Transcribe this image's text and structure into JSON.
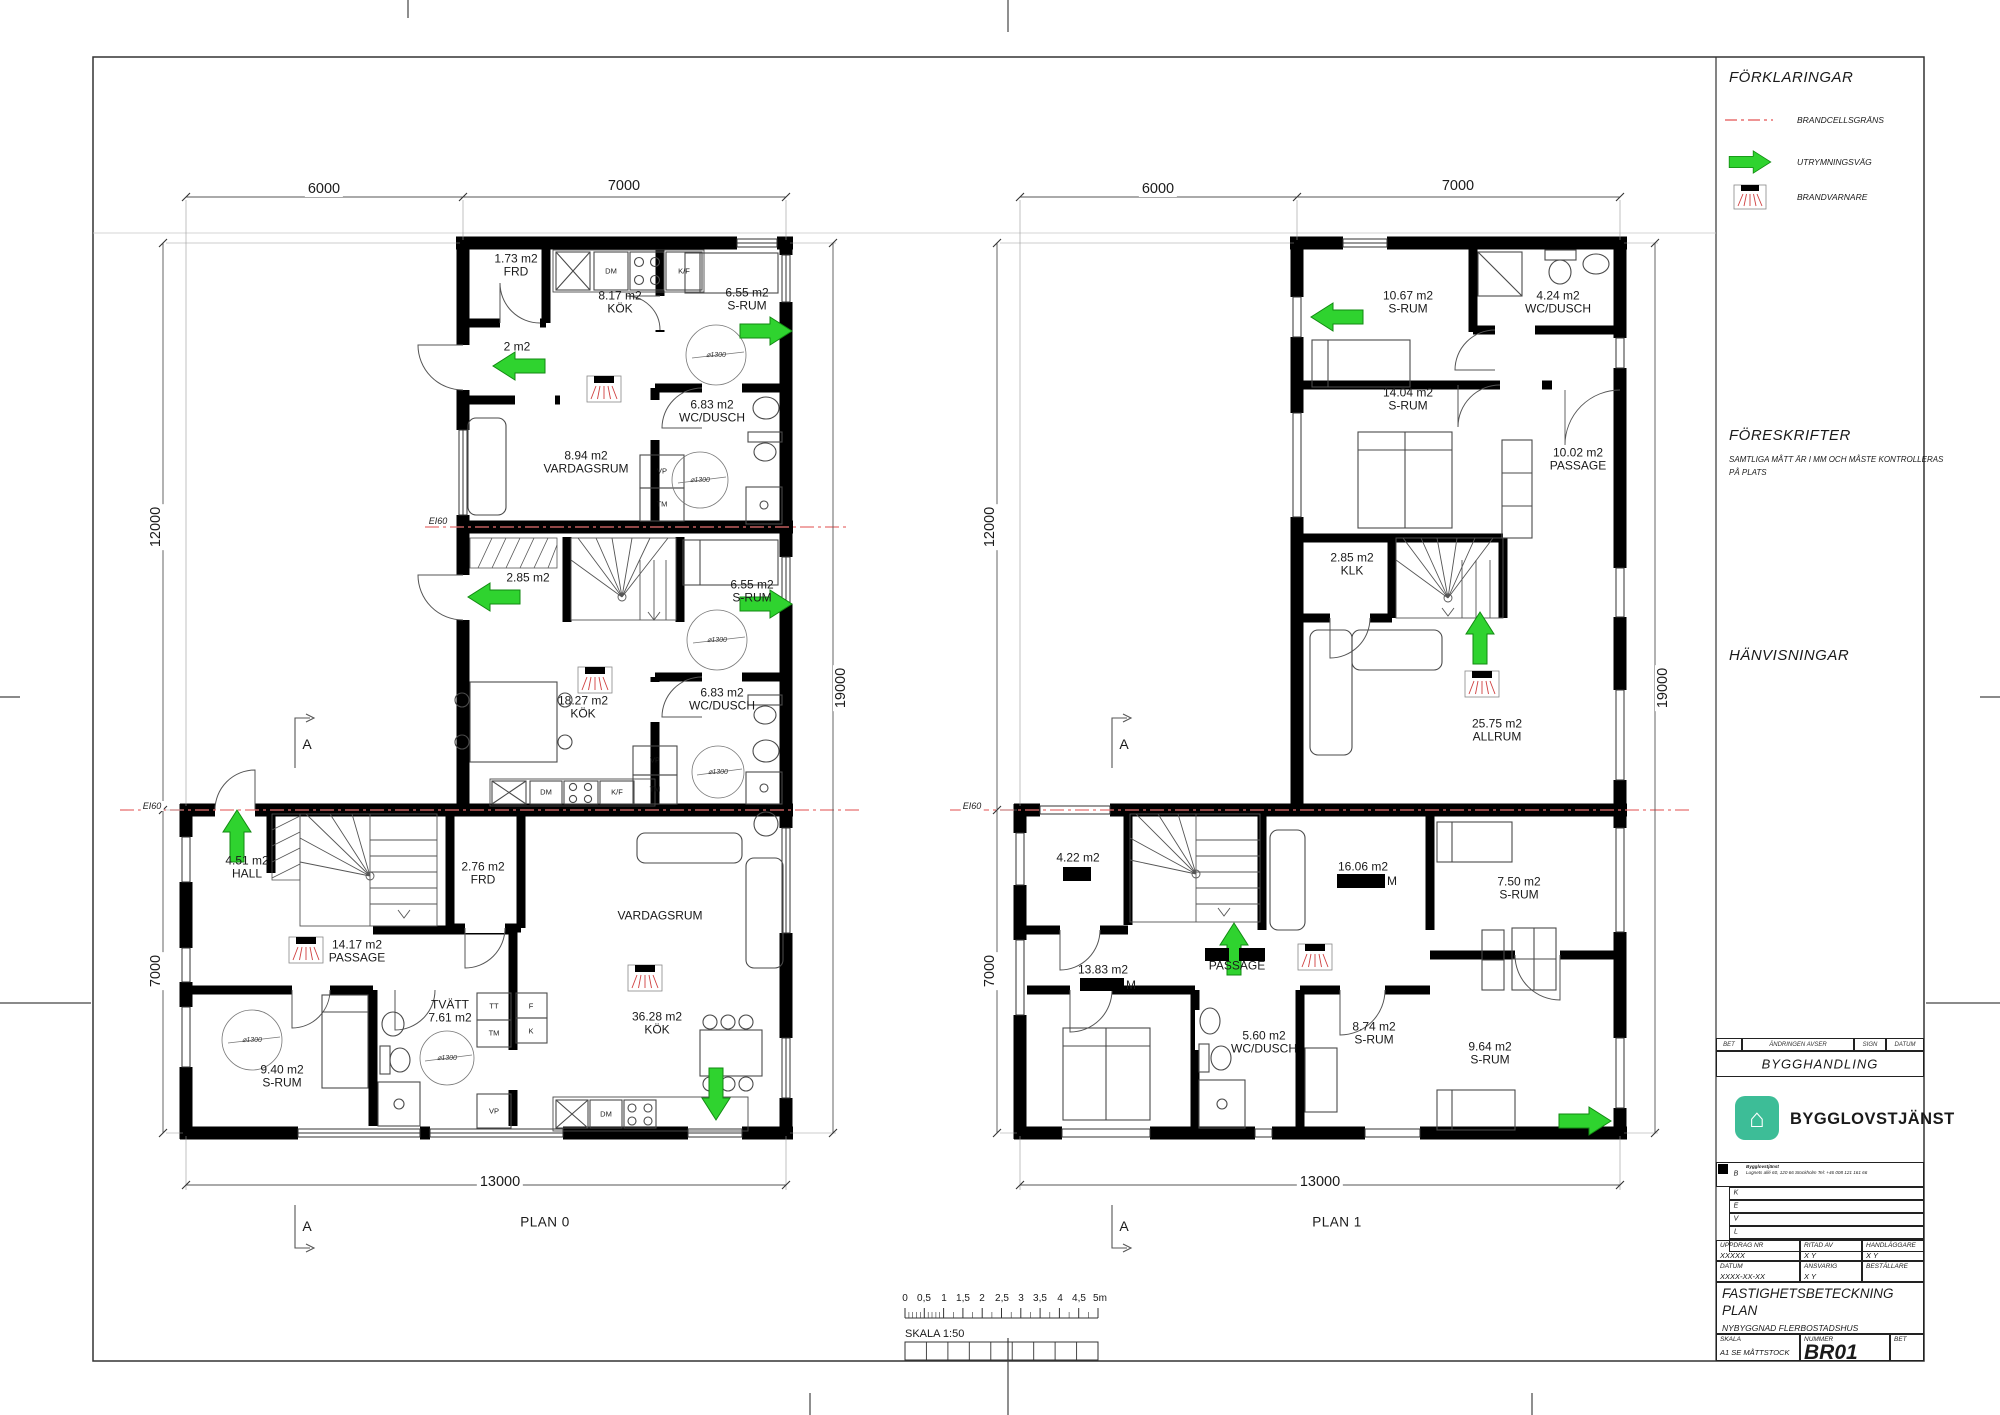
{
  "sheet": {
    "plan0_title": "PLAN 0",
    "plan1_title": "PLAN 1"
  },
  "colors": {
    "evacuation_green": "#2fd32f",
    "firecell_red": "#e87070",
    "logo_teal": "#3dbd97"
  },
  "dims": {
    "w6000": "6000",
    "w7000": "7000",
    "h12000": "12000",
    "h7000": "7000",
    "h19000": "19000",
    "w13000": "13000"
  },
  "misc": {
    "diameter": "⌀1300",
    "ei60": "EI60",
    "section_letter": "A"
  },
  "fixtures": {
    "dm": "DM",
    "kf": "K/F",
    "vp": "VP",
    "tm": "TM",
    "tt": "TT",
    "f": "F",
    "k": "K"
  },
  "plan0": {
    "rooms": {
      "frd_top": {
        "area": "1.73 m2",
        "name": "FRD"
      },
      "kok_top": {
        "area": "8.17 m2",
        "name": "KÖK"
      },
      "srum_top": {
        "area": "6.55 m2",
        "name": "S-RUM"
      },
      "hall_top": {
        "area": "2 m2"
      },
      "wc_top": {
        "area": "6.83 m2",
        "name": "WC/DUSCH"
      },
      "vardagsrum_top": {
        "area": "8.94 m2",
        "name": "VARDAGSRUM"
      },
      "hall_mid": {
        "area": "2.85 m2"
      },
      "srum_mid": {
        "area": "6.55 m2",
        "name": "S-RUM"
      },
      "kok_mid": {
        "area": "18.27 m2",
        "name": "KÖK"
      },
      "wc_mid": {
        "area": "6.83 m2",
        "name": "WC/DUSCH"
      },
      "hall_bot": {
        "area": "4.51 m2",
        "name": "HALL"
      },
      "frd_bot": {
        "area": "2.76 m2",
        "name": "FRD"
      },
      "passage_bot": {
        "area": "14.17 m2",
        "name": "PASSAGE"
      },
      "srum_bot": {
        "area": "9.40 m2",
        "name": "S-RUM"
      },
      "tvatt": {
        "name": "TVÄTT",
        "area": "7.61 m2"
      },
      "vardagsrum_bot": {
        "name": "VARDAGSRUM"
      },
      "kok_bot": {
        "area": "36.28 m2",
        "name": "KÖK"
      }
    }
  },
  "plan1": {
    "rooms": {
      "srum_1067": {
        "area": "10.67 m2",
        "name": "S-RUM"
      },
      "wc_424": {
        "area": "4.24 m2",
        "name": "WC/DUSCH"
      },
      "srum_1404": {
        "area": "14.04 m2",
        "name": "S-RUM"
      },
      "passage_1002": {
        "area": "10.02 m2",
        "name": "PASSAGE"
      },
      "klk": {
        "area": "2.85 m2",
        "name": "KLK"
      },
      "allrum": {
        "area": "25.75 m2",
        "name": "ALLRUM"
      },
      "r422": {
        "area": "4.22 m2"
      },
      "r1383": {
        "area": "13.83 m2",
        "name_suffix": "M"
      },
      "r1606": {
        "area": "16.06 m2",
        "name_suffix": "M"
      },
      "passage2": {
        "name": "PASSAGE"
      },
      "wc_560": {
        "area": "5.60 m2",
        "name": "WC/DUSCH"
      },
      "srum_874": {
        "area": "8.74 m2",
        "name": "S-RUM"
      },
      "srum_750": {
        "area": "7.50 m2",
        "name": "S-RUM"
      },
      "srum_964": {
        "area": "9.64 m2",
        "name": "S-RUM"
      }
    }
  },
  "legend": {
    "title": "FÖRKLARINGAR",
    "items": [
      {
        "symbol": "firecell-line",
        "label": "BRANDCELLSGRÄNS"
      },
      {
        "symbol": "evacuation-arrow",
        "label": "UTRYMNINGSVÄG"
      },
      {
        "symbol": "smoke-detector",
        "label": "BRANDVARNARE"
      }
    ]
  },
  "foreskrifter": {
    "title": "FÖRESKRIFTER",
    "line1": "SAMTLIGA MÅTT ÄR I MM OCH MÅSTE KONTROLLERAS",
    "line2": "PÅ PLATS"
  },
  "hanvisningar": {
    "title": "HÄNVISNINGAR"
  },
  "scalebar": {
    "ticks": [
      "0",
      "0,5",
      "1",
      "1,5",
      "2",
      "2,5",
      "3",
      "3,5",
      "4",
      "4,5",
      "5m"
    ],
    "label": "SKALA 1:50"
  },
  "titleblock": {
    "rev_header": {
      "bet": "BET",
      "andringen": "ÄNDRINGEN AVSER",
      "sign": "SIGN",
      "datum": "DATUM"
    },
    "bygghandling": "BYGGHANDLING",
    "logo_text": "BYGGLOVSTJÄNST",
    "company_name": "Bygglovstjänst",
    "company_address": "Lugnets allé 60, 120 66 Stockholm   Tel: +46 008 121 161 66",
    "discipline_letters": [
      "B",
      "K",
      "E",
      "V",
      "L"
    ],
    "fields": {
      "uppdrag_label": "UPPDRAG NR",
      "uppdrag": "XXXXX",
      "ritad_label": "RITAD AV",
      "ritad": "X Y",
      "handlaggare_label": "HANDLÄGGARE",
      "handlaggare": "X Y",
      "datum_label": "DATUM",
      "datum": "XXXX-XX-XX",
      "ansvarig_label": "ANSVARIG",
      "ansvarig": "X Y",
      "bestallare_label": "BESTÄLLARE",
      "bestallare": "",
      "title_line1": "FASTIGHETSBETECKNING",
      "title_line2": "PLAN",
      "subtitle": "NYBYGGNAD FLERBOSTADSHUS",
      "skala_label": "SKALA",
      "skala": "A1 SE MÅTTSTOCK",
      "nummer_label": "NUMMER",
      "nummer": "BR01",
      "bet_label": "BET",
      "bet": ""
    }
  }
}
